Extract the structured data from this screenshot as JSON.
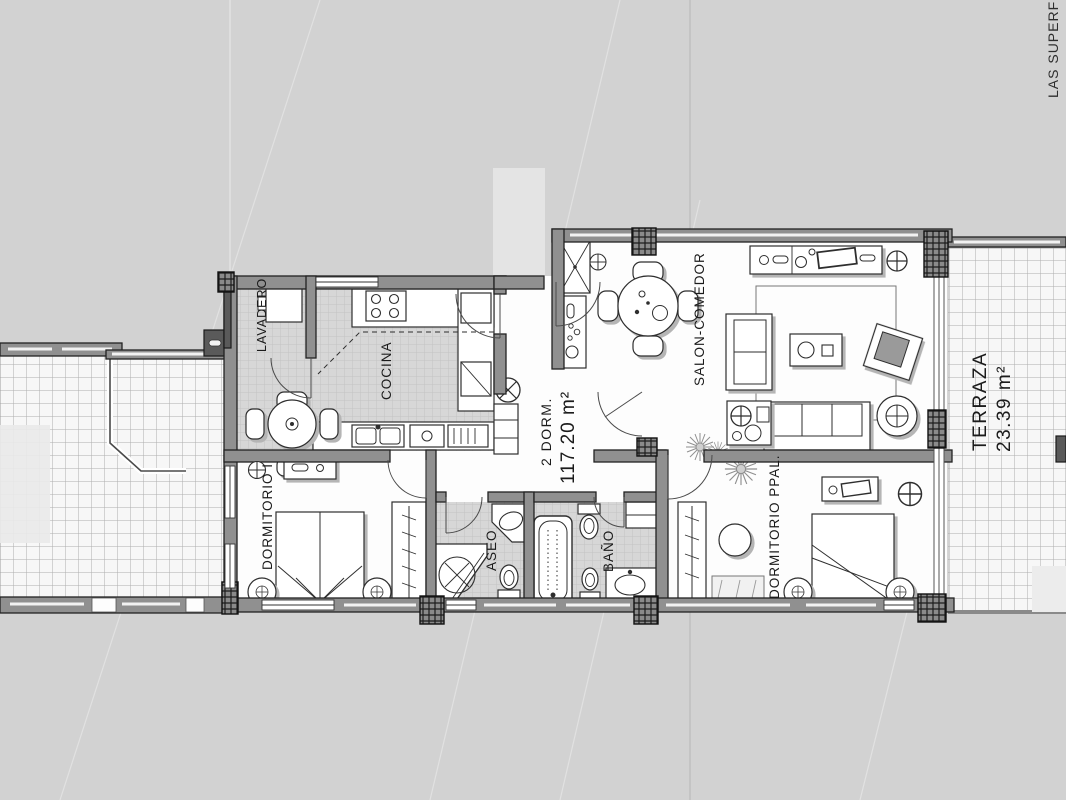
{
  "plan": {
    "unit": {
      "type_label": "2 DORM.",
      "area_label": "117.20 m²"
    },
    "rooms": {
      "lavadero": {
        "label": "LAVADERO"
      },
      "cocina": {
        "label": "COCINA"
      },
      "salon_comedor": {
        "label": "SALON-COMEDOR"
      },
      "dormitorio_1": {
        "label": "DORMITORIO I"
      },
      "aseo": {
        "label": "ASEO"
      },
      "bano": {
        "label": "BAÑO"
      },
      "dormitorio_ppal": {
        "label": "DORMITORIO PPAL."
      },
      "terraza": {
        "label": "TERRAZA",
        "area_label": "23.39 m²"
      }
    },
    "edge_note": "LAS SUPERFICIES",
    "colors": {
      "background": "#d2d2d2",
      "plan_paper": "#fdfdfd",
      "wall_fill": "#909090",
      "wall_outline": "#222222",
      "tile_grid": "#b0b0b0",
      "furniture_shadow": "#b5b5b5",
      "text": "#1b1b1b"
    }
  }
}
